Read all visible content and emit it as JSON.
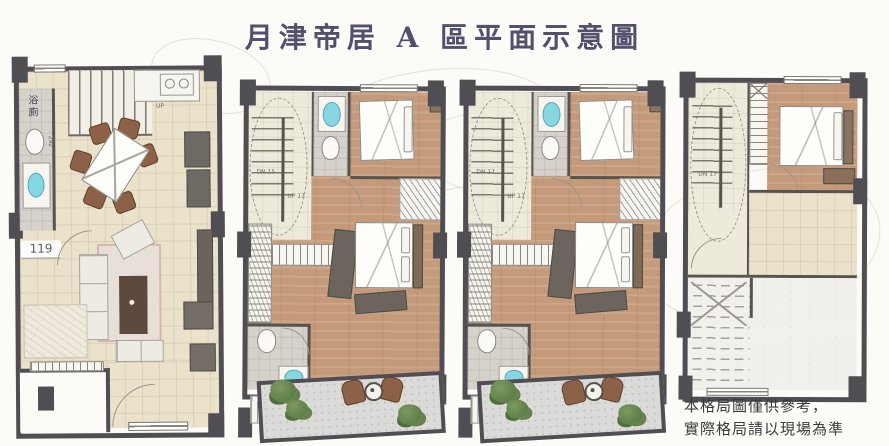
{
  "title": "月津帝居 A 區平面示意圖",
  "disclaimer": {
    "line1": "本格局圖僅供參考，",
    "line2": "實際格局請以現場為準"
  },
  "plans": [
    {
      "bathroom_label": "浴廁",
      "area_label": "119",
      "dimension_label": "292",
      "stair_label": "UP"
    },
    {
      "stair_down_label": "DN 15",
      "stair_up_label": "UP 17"
    },
    {
      "stair_down_label": "DN 17",
      "stair_up_label": "UP 17"
    },
    {
      "stair_down_label": "DN 17"
    }
  ],
  "colors": {
    "wall": "#514e53",
    "cream": "#ebe2cb",
    "wood": "#c49a7a",
    "pale": "#edeadb",
    "cyan": "#87d7e2",
    "plant": "#5e7f49",
    "chair": "#8c6147",
    "terrace": "#dadad8",
    "title": "#534f6c",
    "text": "#3b3b3b",
    "background": "#fcfbf7"
  }
}
